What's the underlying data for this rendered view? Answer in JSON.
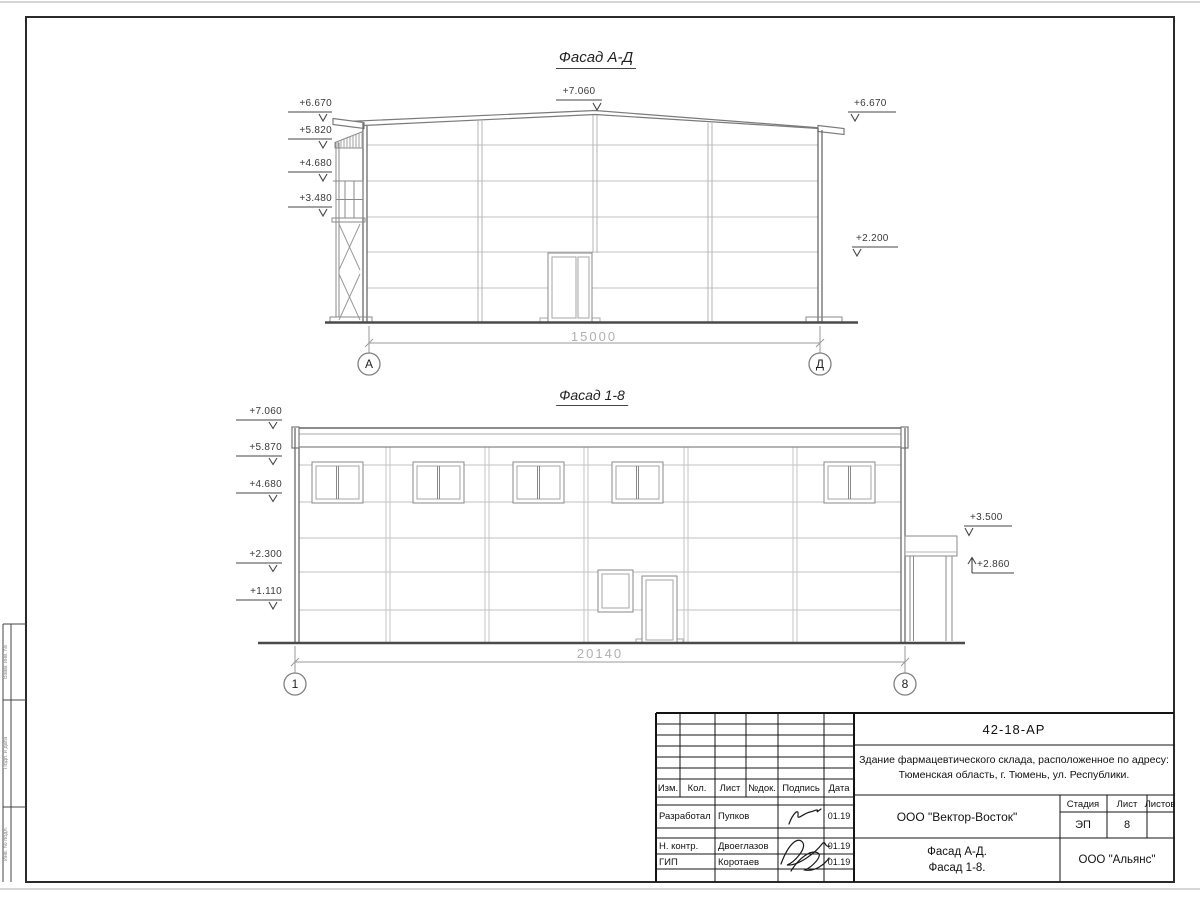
{
  "colors": {
    "frame": "#2a2a2a",
    "line_dark": "#4a4a4a",
    "line_light": "#c2c2c2",
    "dim_text": "#b0b0b0"
  },
  "facade_ad": {
    "title": "Фасад А-Д",
    "mark_top": "+7.060",
    "marks_left": [
      "+6.670",
      "+5.820",
      "+4.680",
      "+3.480"
    ],
    "marks_right": [
      "+6.670",
      "+2.200"
    ],
    "dimension": "15000",
    "axis_left": "А",
    "axis_right": "Д"
  },
  "facade_18": {
    "title": "Фасад 1-8",
    "marks_left": [
      "+7.060",
      "+5.870",
      "+4.680",
      "+2.300",
      "+1.110"
    ],
    "marks_right": [
      "+3.500",
      "+2.860"
    ],
    "dimension": "20140",
    "axis_left": "1",
    "axis_right": "8"
  },
  "titleblock": {
    "doc_number": "42-18-АР",
    "project_line1": "Здание фармацевтического склада, расположенное по адресу:",
    "project_line2": "Тюменская область, г. Тюмень, ул. Республики.",
    "header": {
      "izm": "Изм.",
      "kol": "Кол.",
      "list": "Лист",
      "ndok": "№док.",
      "podpis": "Подпись",
      "data": "Дата"
    },
    "rows": [
      {
        "role": "Разработал",
        "name": "Пупков",
        "date": "01.19"
      },
      {
        "role": "Н. контр.",
        "name": "Двоеглазов",
        "date": "01.19"
      },
      {
        "role": "ГИП",
        "name": "Коротаев",
        "date": "01.19"
      }
    ],
    "designer_org": "ООО \"Вектор-Восток\"",
    "stage_label": "Стадия",
    "sheet_label": "Лист",
    "sheets_label": "Листов",
    "stage": "ЭП",
    "sheet_no": "8",
    "sheets_total": "",
    "drawing_name1": "Фасад А-Д.",
    "drawing_name2": "Фасад 1-8.",
    "client_org": "ООО \"Альянс\""
  },
  "margin_boxes": [
    "Взам. инв. №",
    "Подп. и дата",
    "Инв. № подл."
  ]
}
